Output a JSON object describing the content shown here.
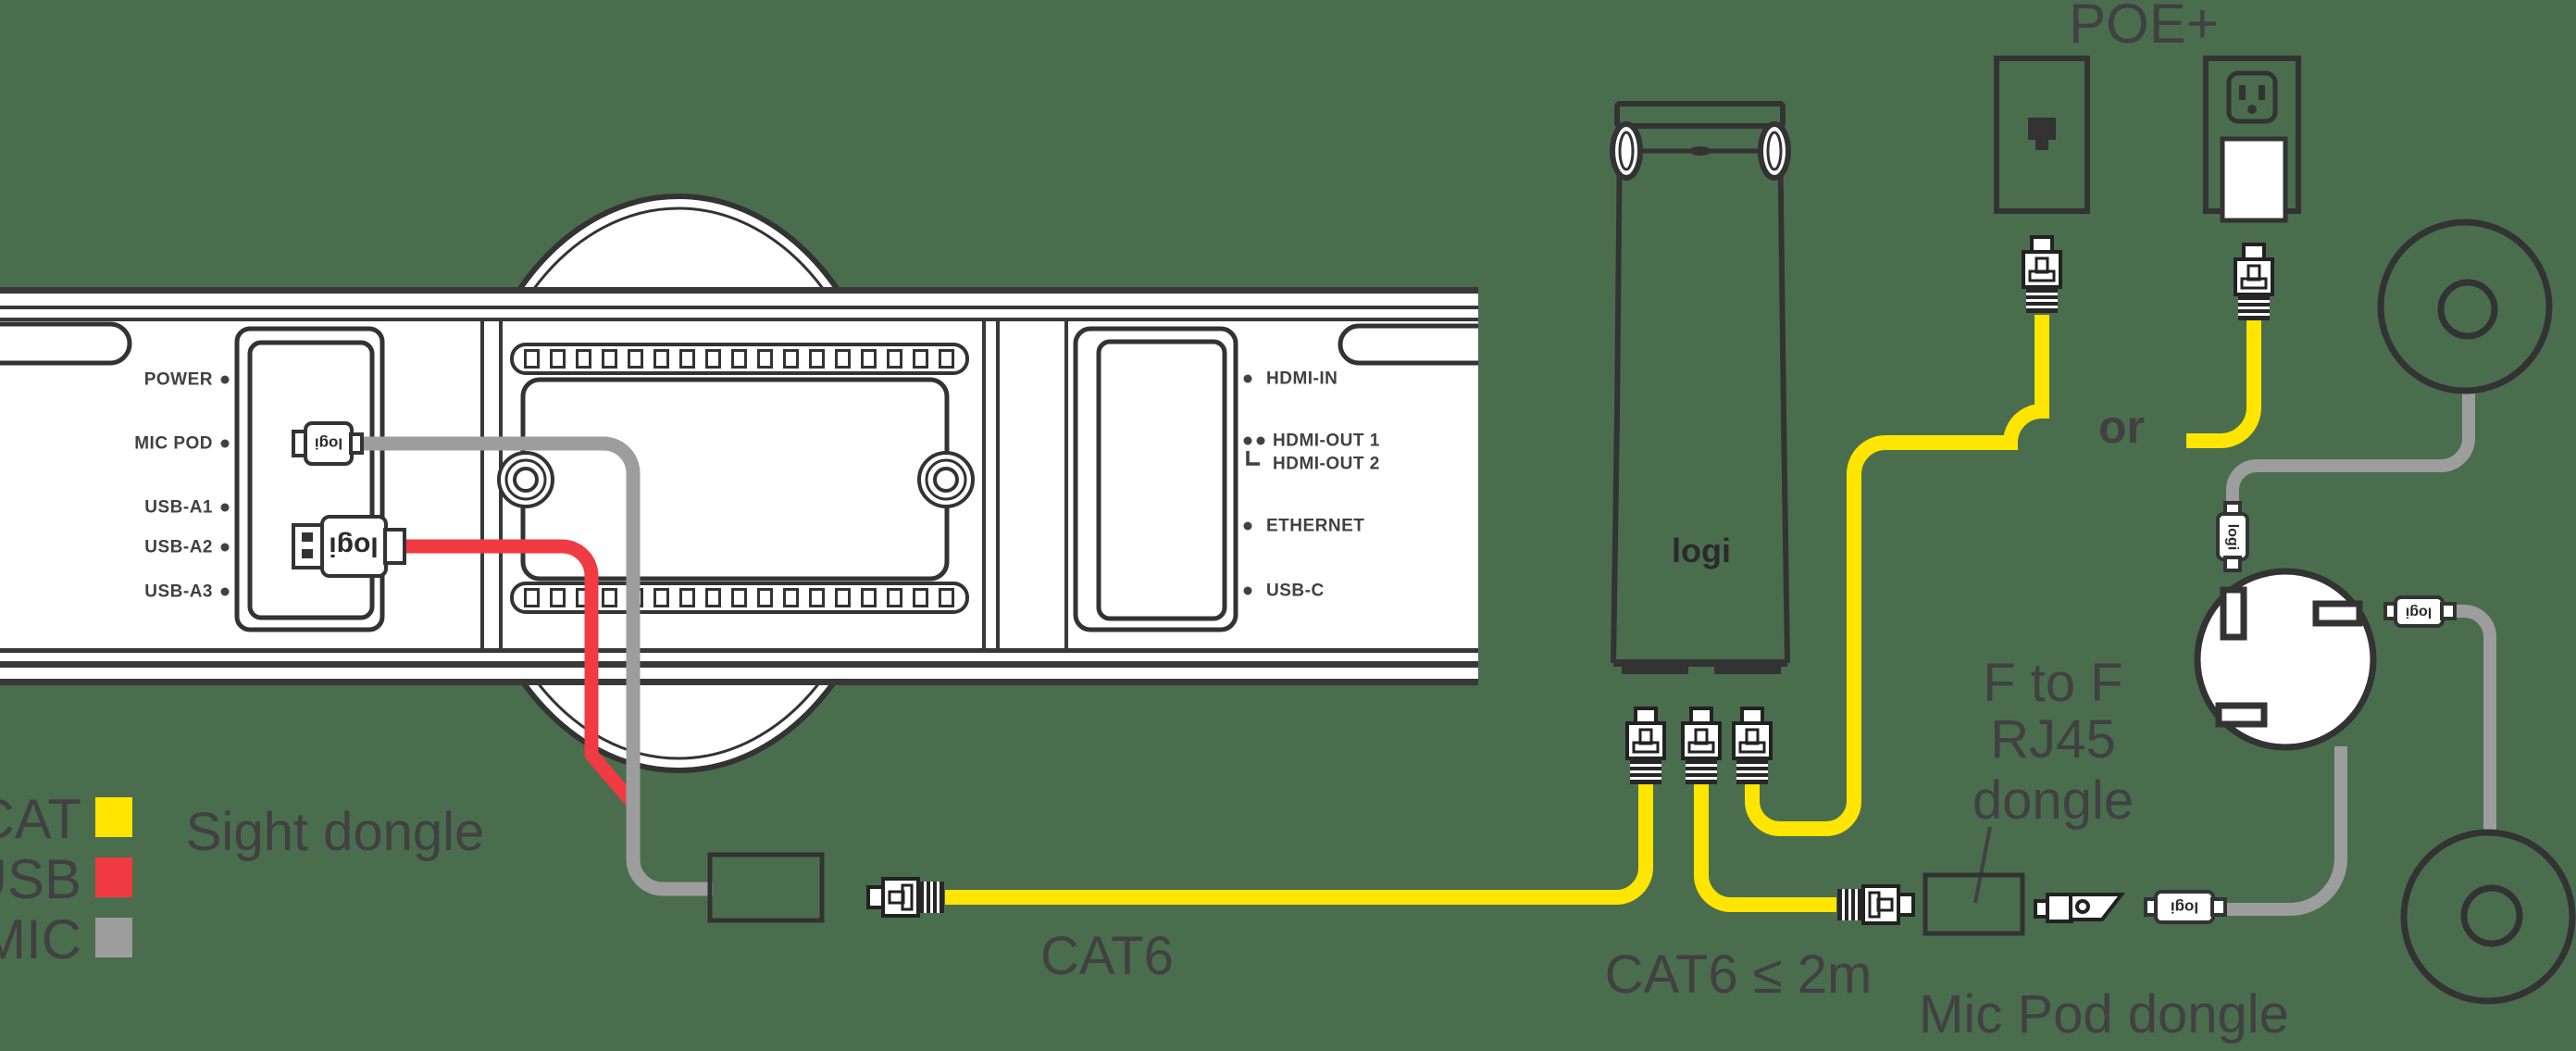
{
  "legend": {
    "items": [
      {
        "label": "CAT",
        "color": "#FFE500"
      },
      {
        "label": "USB",
        "color": "#EF3B41"
      },
      {
        "label": "MIC",
        "color": "#9D9D9D"
      }
    ]
  },
  "bar": {
    "ports_left": [
      "POWER",
      "MIC POD",
      "USB-A1",
      "USB-A2",
      "USB-A3"
    ],
    "ports_right": [
      "HDMI-IN",
      "HDMI-OUT 1",
      "HDMI-OUT 2",
      "ETHERNET",
      "USB-C"
    ]
  },
  "labels": {
    "sight_dongle": "Sight dongle",
    "cat6": "CAT6",
    "cat6_max": "CAT6 ≤ 2m",
    "f_to_f_1": "F to F",
    "f_to_f_2": "RJ45",
    "f_to_f_3": "dongle",
    "poe": "POE+",
    "or": "or",
    "mic_pod_dongle": "Mic Pod dongle"
  },
  "logo": {
    "text": "logi"
  },
  "colors": {
    "cat_cable": "#FFE500",
    "usb_cable": "#EF3B41",
    "mic_cable": "#9D9D9D",
    "background": "#4A6D4E",
    "outline": "#333333",
    "text": "#414042"
  }
}
